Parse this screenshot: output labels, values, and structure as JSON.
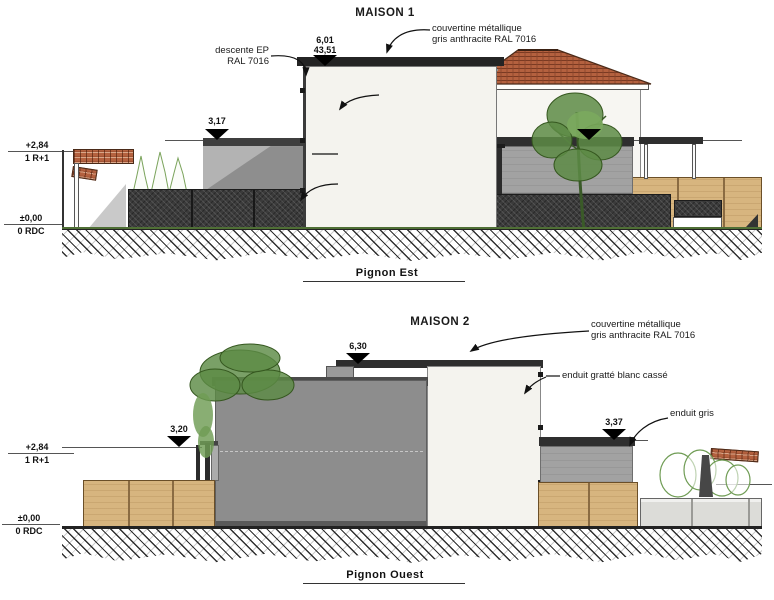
{
  "colors": {
    "white_wall": "#f4f3ee",
    "grey_wall": "#a2a2a2",
    "dark_grey_wall": "#8d8d8d",
    "fence_dark": "#3b3b3b",
    "wood_fence": "#d7b57f",
    "roof_tile": "#b4613f",
    "tree_green": "#5d8b45",
    "line": "#1a1a1a"
  },
  "s1": {
    "title": "MAISON 1",
    "caption": "Pignon  Est",
    "ann": {
      "couvertine": "couvertine métallique\ngris anthracite RAL 7016",
      "descente": "descente EP\nRAL 7016",
      "enduit_blanc": "enduit gratté blanc cassé",
      "enduit_gris": "enduit gris",
      "cloture": "clôture: grillage + poteaux métalliques\ngris h=1.50m doublée d'une haie vive"
    },
    "dims": {
      "roof": "6,01",
      "roof_total": "43,51",
      "wall_left": "3,17",
      "wall_right": "3,00"
    },
    "levels": {
      "upper": "+2,84",
      "upper_label": "1 R+1",
      "ground": "±0,00",
      "ground_label": "0 RDC"
    }
  },
  "s2": {
    "title": "MAISON 2",
    "caption": "Pignon Ouest",
    "ann": {
      "couvertine": "couvertine métallique\ngris anthracite RAL 7016",
      "enduit_blanc": "enduit gratté blanc cassé",
      "enduit_gris": "enduit gris"
    },
    "dims": {
      "roof": "6,30",
      "wall_left": "3,20",
      "wall_right": "3,37"
    },
    "levels": {
      "upper": "+2,84",
      "upper_label": "1 R+1",
      "ground": "±0,00",
      "ground_label": "0 RDC"
    }
  }
}
